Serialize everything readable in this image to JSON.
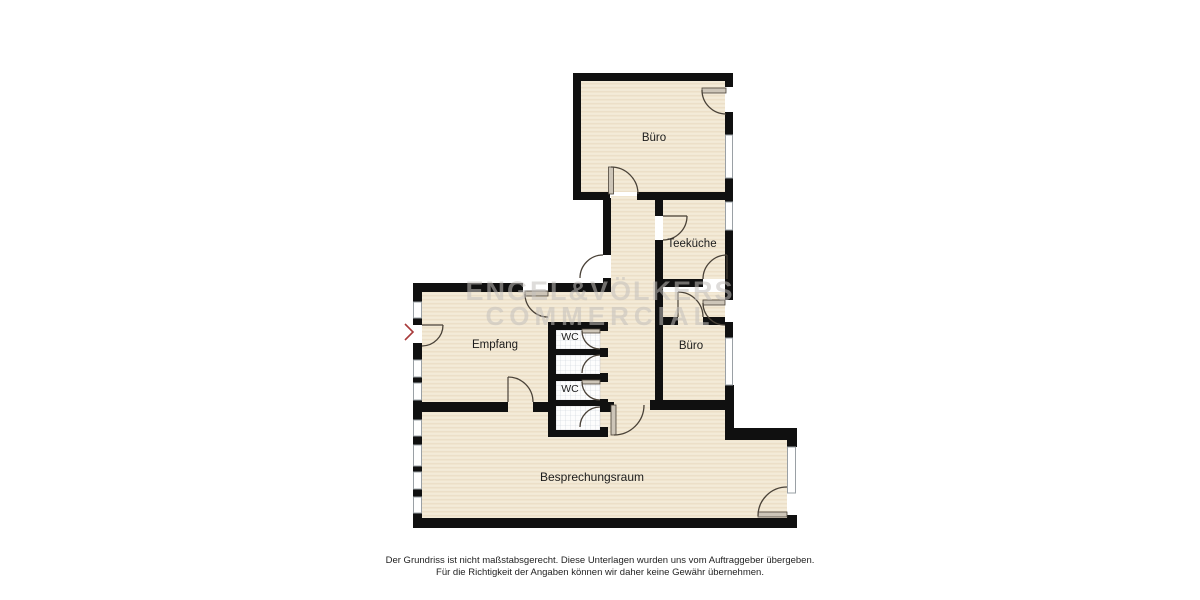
{
  "floorplan": {
    "title": "Bürofläche Grundriss",
    "watermark": {
      "line1": "ENGEL&VÖLKERS",
      "line2": "COMMERCIAL"
    },
    "rooms": {
      "buero_top": {
        "label": "Büro"
      },
      "teekueche": {
        "label": "Teeküche"
      },
      "empfang": {
        "label": "Empfang"
      },
      "wc_top": {
        "label": "WC"
      },
      "wc_bottom": {
        "label": "WC"
      },
      "buero_right": {
        "label": "Büro"
      },
      "besprechungsraum": {
        "label": "Besprechungsraum"
      }
    },
    "icons": {
      "entrance_marker": "chevron-right"
    },
    "colors": {
      "wall": "#101010",
      "floor": "#f1e6d0",
      "tile_grid": "#ccd0da",
      "door_arc": "#4a4238",
      "window_frame": "#9aa0a5",
      "watermark": "#c2c0bc",
      "entrance_marker": "#a83a3a"
    },
    "disclaimer": {
      "line1": "Der Grundriss ist nicht maßstabsgerecht. Diese Unterlagen wurden uns vom Auftraggeber übergeben.",
      "line2": "Für die Richtigkeit der Angaben können wir daher keine Gewähr übernehmen."
    }
  }
}
